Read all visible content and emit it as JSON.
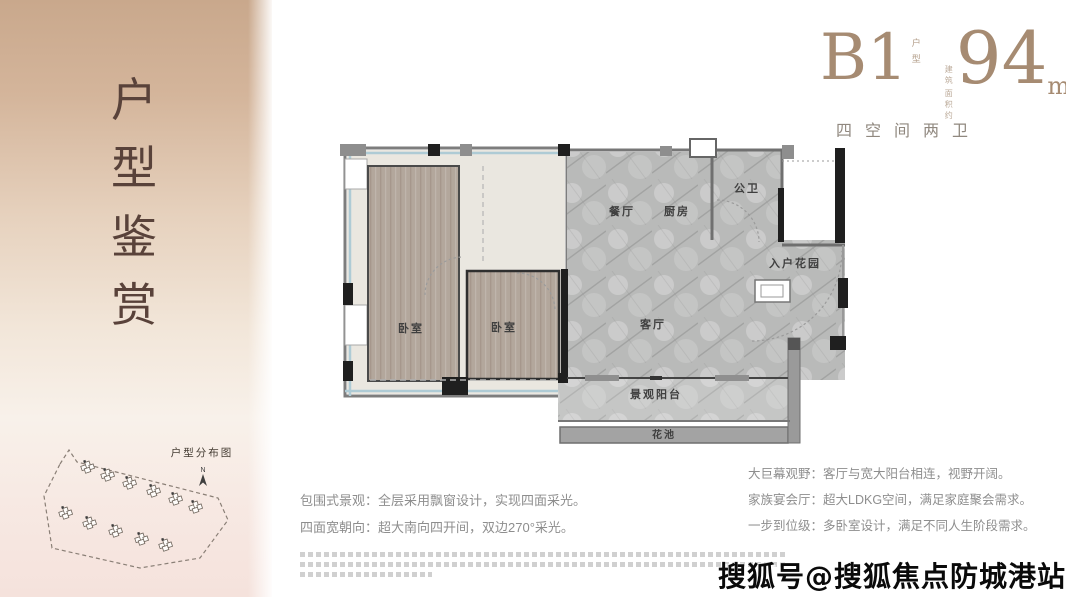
{
  "sidebar": {
    "title_chars": [
      "户",
      "型",
      "鉴",
      "赏"
    ],
    "site_plan": {
      "label": "户型分布图",
      "north": "N"
    }
  },
  "header": {
    "unit_code": "B1",
    "unit_tag_chars": [
      "户",
      "型"
    ],
    "area_prefix_lines": [
      "建筑",
      "面积约"
    ],
    "area_value": "94",
    "area_unit": "m²",
    "subtitle": "四空间两卫"
  },
  "plan": {
    "dining": "餐厅",
    "kitchen": "厨房",
    "bathroom": "公卫",
    "entry_garden": "入户花园",
    "bedroom_left": "卧室",
    "bedroom_mid": "卧室",
    "living": "客厅",
    "balcony": "景观阳台",
    "flower_bed": "花池"
  },
  "features_left": [
    "包围式景观：全层采用飘窗设计，实现四面采光。",
    "四面宽朝向：超大南向四开间，双边270°采光。"
  ],
  "features_right": [
    "大巨幕观野：客厅与宽大阳台相连，视野开阔。",
    "家族宴会厅：超大LDKG空间，满足家庭聚会需求。",
    "一步到位级：多卧室设计，满足不同人生阶段需求。"
  ],
  "watermark": "搜狐号@搜狐焦点防城港站",
  "colors": {
    "sidebar_top": "#c9a88c",
    "sidebar_bottom": "#f5e2dc",
    "sidebar_text": "#59423a",
    "accent_bronze": "#a68b72",
    "wood_floor": "#b3a79c",
    "marble_floor": "#b9bab9",
    "wall_dark": "#1f1f1f",
    "glass_window": "#aecbd5"
  }
}
